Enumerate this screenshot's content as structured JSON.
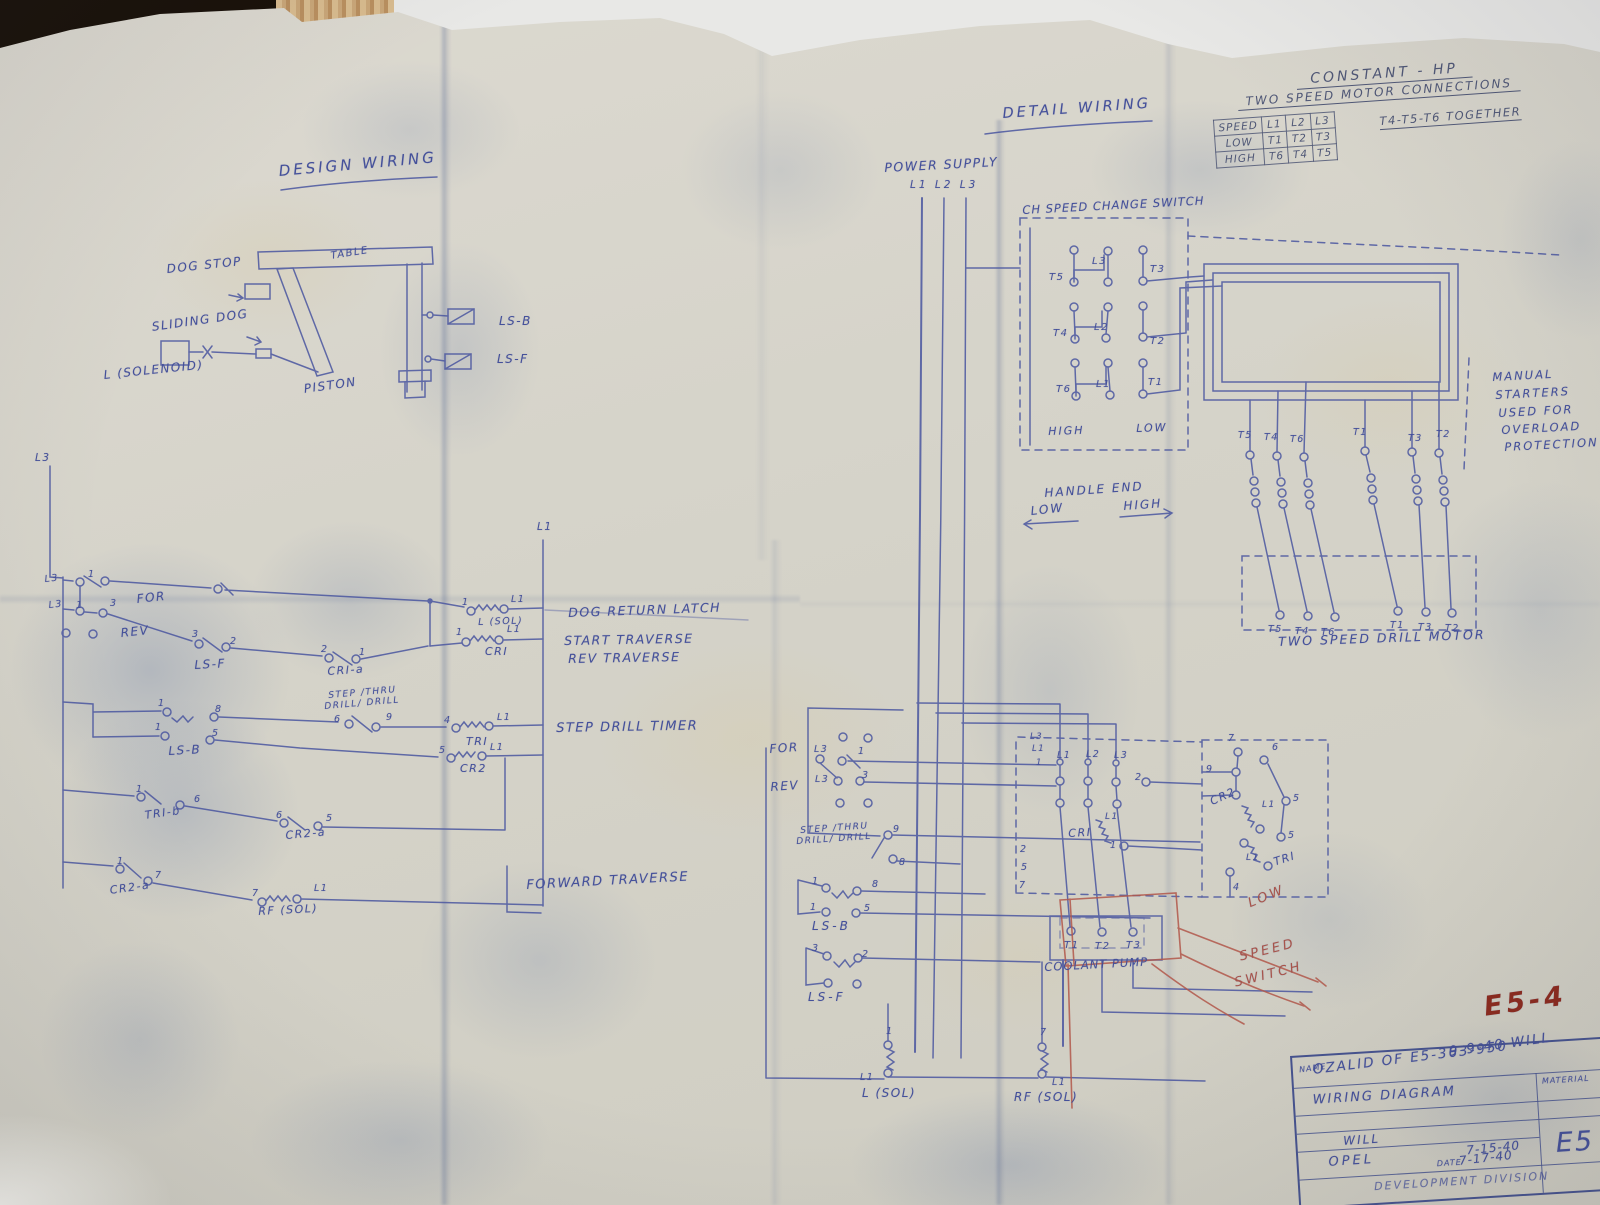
{
  "colors": {
    "ink": "#44509a",
    "table": "#4f5776",
    "red": "#a8544a",
    "marker": "#8c2a1e"
  },
  "titles": {
    "design_wiring": "DESIGN WIRING",
    "detail_wiring": "DETAIL WIRING"
  },
  "constant_hp_table": {
    "title_line1": "CONSTANT - HP",
    "title_line2": "TWO SPEED MOTOR CONNECTIONS",
    "header": [
      "SPEED",
      "L1",
      "L2",
      "L3"
    ],
    "rows": [
      {
        "speed": "LOW",
        "t": [
          "T1",
          "T2",
          "T3"
        ],
        "note": "T4-T5-T6 TOGETHER"
      },
      {
        "speed": "HIGH",
        "t": [
          "T6",
          "T4",
          "T5"
        ],
        "note": ""
      }
    ]
  },
  "title_block": {
    "name_label": "NAME",
    "drawing_name": "WIRING DIAGRAM",
    "material_label": "MATERIAL",
    "drawn_by": "WILL",
    "checked_by": "OPEL",
    "date_1": "7-15-40",
    "date_label": "DATE",
    "date_2": "7-17-40",
    "drawing_number": "E5",
    "division": "DEVELOPMENT DIVISION"
  },
  "annotations": [
    {
      "n": "label-dog-stop",
      "t": "DOG STOP",
      "x": 166,
      "y": 262,
      "fs": 12,
      "r": -6
    },
    {
      "n": "label-sliding-dog",
      "t": "SLIDING DOG",
      "x": 151,
      "y": 320,
      "fs": 12,
      "r": -8
    },
    {
      "n": "label-l-solenoid",
      "t": "L (SOLENOID)",
      "x": 103,
      "y": 368,
      "fs": 12,
      "r": -6
    },
    {
      "n": "label-piston",
      "t": "PISTON",
      "x": 303,
      "y": 382,
      "fs": 12,
      "r": -8
    },
    {
      "n": "label-table",
      "t": "TABLE",
      "x": 330,
      "y": 251,
      "fs": 10,
      "r": -9
    },
    {
      "n": "label-ls-b-mech",
      "t": "LS-B",
      "x": 499,
      "y": 314,
      "fs": 12
    },
    {
      "n": "label-ls-f-mech",
      "t": "LS-F",
      "x": 497,
      "y": 352,
      "fs": 12
    },
    {
      "n": "label-l3-feeder",
      "t": "L3",
      "x": 35,
      "y": 452,
      "fs": 10.5
    },
    {
      "n": "label-l1-bus",
      "t": "L1",
      "x": 537,
      "y": 521,
      "fs": 10.5
    },
    {
      "n": "label-l3-row1",
      "t": "L3",
      "x": 44,
      "y": 574,
      "fs": 9.5,
      "r": -6
    },
    {
      "n": "num-row1-1",
      "t": "1",
      "x": 88,
      "y": 569,
      "fs": 9.5
    },
    {
      "n": "label-for",
      "t": "FOR",
      "x": 136,
      "y": 592,
      "fs": 12,
      "r": -6
    },
    {
      "n": "label-l3-row2",
      "t": "L3",
      "x": 48,
      "y": 600,
      "fs": 9.5,
      "r": -6
    },
    {
      "n": "num-row2-1",
      "t": "1",
      "x": 76,
      "y": 600,
      "fs": 9.5
    },
    {
      "n": "num-row2-3",
      "t": "3",
      "x": 110,
      "y": 598,
      "fs": 9.5
    },
    {
      "n": "label-rev",
      "t": "REV",
      "x": 120,
      "y": 626,
      "fs": 12,
      "r": -6
    },
    {
      "n": "num-lsf-3",
      "t": "3",
      "x": 192,
      "y": 629,
      "fs": 9.5
    },
    {
      "n": "num-lsf-2",
      "t": "2",
      "x": 230,
      "y": 636,
      "fs": 9.5
    },
    {
      "n": "label-ladder-ls-f",
      "t": "LS-F",
      "x": 194,
      "y": 658,
      "fs": 12,
      "r": -3
    },
    {
      "n": "num-cria-2",
      "t": "2",
      "x": 321,
      "y": 644,
      "fs": 9.5
    },
    {
      "n": "num-cria-1",
      "t": "1",
      "x": 359,
      "y": 647,
      "fs": 9.5
    },
    {
      "n": "label-cri-a",
      "t": "CRI-a",
      "x": 327,
      "y": 665,
      "fs": 11,
      "r": -4
    },
    {
      "n": "num-rowa-1",
      "t": "1",
      "x": 462,
      "y": 597,
      "fs": 9.5
    },
    {
      "n": "label-rowa-l1",
      "t": "L1",
      "x": 511,
      "y": 594,
      "fs": 9.5
    },
    {
      "n": "label-l-sol-coil",
      "t": "L (SOL)",
      "x": 478,
      "y": 617,
      "fs": 9.5,
      "r": -2
    },
    {
      "n": "caption-dog-return-latch",
      "t": "DOG RETURN LATCH",
      "x": 568,
      "y": 605,
      "fs": 12.5,
      "r": -2
    },
    {
      "n": "num-rowb-1",
      "t": "1",
      "x": 456,
      "y": 627,
      "fs": 9.5
    },
    {
      "n": "label-rowb-l1",
      "t": "L1",
      "x": 507,
      "y": 624,
      "fs": 9.5
    },
    {
      "n": "label-cri-coil",
      "t": "CRI",
      "x": 485,
      "y": 645,
      "fs": 11
    },
    {
      "n": "caption-start-traverse",
      "t": "START TRAVERSE",
      "x": 564,
      "y": 633,
      "fs": 12.5,
      "r": -1
    },
    {
      "n": "caption-rev-traverse",
      "t": "REV TRAVERSE",
      "x": 568,
      "y": 651,
      "fs": 12.5,
      "r": -1
    },
    {
      "n": "num-lsb-1a",
      "t": "1",
      "x": 158,
      "y": 698,
      "fs": 9.5
    },
    {
      "n": "num-lsb-8",
      "t": "8",
      "x": 215,
      "y": 704,
      "fs": 9.5
    },
    {
      "n": "num-lsb-1b",
      "t": "1",
      "x": 155,
      "y": 722,
      "fs": 9.5
    },
    {
      "n": "num-lsb-5",
      "t": "5",
      "x": 212,
      "y": 728,
      "fs": 9.5
    },
    {
      "n": "label-ladder-ls-b",
      "t": "LS-B",
      "x": 168,
      "y": 744,
      "fs": 12,
      "r": -3
    },
    {
      "n": "label-ladder-sel-top",
      "t": "STEP /THRU",
      "x": 328,
      "y": 691,
      "fs": 9,
      "r": -5
    },
    {
      "n": "label-ladder-sel-bot",
      "t": "DRILL/ DRILL",
      "x": 324,
      "y": 702,
      "fs": 9,
      "r": -5
    },
    {
      "n": "num-sel-6",
      "t": "6",
      "x": 334,
      "y": 714,
      "fs": 9.5
    },
    {
      "n": "num-sel-9",
      "t": "9",
      "x": 386,
      "y": 712,
      "fs": 9.5
    },
    {
      "n": "num-rowc-4",
      "t": "4",
      "x": 444,
      "y": 715,
      "fs": 9.5
    },
    {
      "n": "label-rowc-l1",
      "t": "L1",
      "x": 497,
      "y": 712,
      "fs": 9.5
    },
    {
      "n": "label-tri-coil",
      "t": "TRI",
      "x": 466,
      "y": 735,
      "fs": 11
    },
    {
      "n": "caption-step-drill-timer",
      "t": "STEP DRILL TIMER",
      "x": 556,
      "y": 721,
      "fs": 13,
      "r": -1
    },
    {
      "n": "num-rowd-5",
      "t": "5",
      "x": 439,
      "y": 745,
      "fs": 9.5
    },
    {
      "n": "label-rowd-l1",
      "t": "L1",
      "x": 490,
      "y": 742,
      "fs": 9.5
    },
    {
      "n": "label-cr2-coil",
      "t": "CR2",
      "x": 460,
      "y": 762,
      "fs": 11
    },
    {
      "n": "num-trib-1",
      "t": "1",
      "x": 136,
      "y": 784,
      "fs": 9.5
    },
    {
      "n": "num-trib-6",
      "t": "6",
      "x": 194,
      "y": 794,
      "fs": 9.5
    },
    {
      "n": "label-tri-b",
      "t": "TRI-b",
      "x": 144,
      "y": 809,
      "fs": 11,
      "r": -8
    },
    {
      "n": "num-cr2a1-6",
      "t": "6",
      "x": 276,
      "y": 810,
      "fs": 9.5
    },
    {
      "n": "num-cr2a1-5",
      "t": "5",
      "x": 326,
      "y": 813,
      "fs": 9.5
    },
    {
      "n": "label-cr2-a-1",
      "t": "CR2-a",
      "x": 285,
      "y": 829,
      "fs": 11,
      "r": -5
    },
    {
      "n": "num-cr2a2-1",
      "t": "1",
      "x": 117,
      "y": 856,
      "fs": 9.5
    },
    {
      "n": "num-cr2a2-7",
      "t": "7",
      "x": 155,
      "y": 870,
      "fs": 9.5
    },
    {
      "n": "label-cr2-a-2",
      "t": "CR2-a",
      "x": 109,
      "y": 884,
      "fs": 11,
      "r": -8
    },
    {
      "n": "num-rowe-7",
      "t": "7",
      "x": 252,
      "y": 888,
      "fs": 9.5
    },
    {
      "n": "label-rowe-l1",
      "t": "L1",
      "x": 314,
      "y": 883,
      "fs": 9.5
    },
    {
      "n": "label-rf-sol-coil",
      "t": "RF (SOL)",
      "x": 258,
      "y": 905,
      "fs": 11,
      "r": -3
    },
    {
      "n": "caption-forward-traverse",
      "t": "FORWARD TRAVERSE",
      "x": 526,
      "y": 878,
      "fs": 13,
      "r": -3
    },
    {
      "n": "label-power-supply",
      "t": "POWER SUPPLY",
      "x": 884,
      "y": 160,
      "fs": 12.5,
      "r": -3
    },
    {
      "n": "label-power-lines",
      "t": "L1 L2 L3",
      "x": 910,
      "y": 179,
      "fs": 10.5,
      "ls": 3
    },
    {
      "n": "label-speed-change-switch",
      "t": "CH SPEED CHANGE SWITCH",
      "x": 1022,
      "y": 203,
      "fs": 11.5,
      "r": -3,
      "ls": 1
    },
    {
      "n": "label-sw-l3",
      "t": "L3",
      "x": 1092,
      "y": 256,
      "fs": 10
    },
    {
      "n": "label-sw-t5",
      "t": "T5",
      "x": 1049,
      "y": 272,
      "fs": 10
    },
    {
      "n": "label-sw-t3",
      "t": "T3",
      "x": 1150,
      "y": 264,
      "fs": 10
    },
    {
      "n": "label-sw-t4",
      "t": "T4",
      "x": 1053,
      "y": 328,
      "fs": 10
    },
    {
      "n": "label-sw-l2",
      "t": "L2",
      "x": 1094,
      "y": 322,
      "fs": 10
    },
    {
      "n": "label-sw-t2",
      "t": "T2",
      "x": 1150,
      "y": 336,
      "fs": 10
    },
    {
      "n": "label-sw-t6",
      "t": "T6",
      "x": 1056,
      "y": 384,
      "fs": 10
    },
    {
      "n": "label-sw-l1",
      "t": "L1",
      "x": 1096,
      "y": 379,
      "fs": 10
    },
    {
      "n": "label-sw-t1",
      "t": "T1",
      "x": 1148,
      "y": 377,
      "fs": 10
    },
    {
      "n": "label-sw-high",
      "t": "HIGH",
      "x": 1048,
      "y": 425,
      "fs": 11,
      "r": -2,
      "ls": 2
    },
    {
      "n": "label-sw-low",
      "t": "LOW",
      "x": 1136,
      "y": 422,
      "fs": 11,
      "r": -2,
      "ls": 2
    },
    {
      "n": "label-handle-end",
      "t": "HANDLE END",
      "x": 1044,
      "y": 486,
      "fs": 12,
      "r": -4,
      "ls": 2
    },
    {
      "n": "label-handle-low",
      "t": "LOW",
      "x": 1030,
      "y": 504,
      "fs": 12,
      "r": -6,
      "ls": 2
    },
    {
      "n": "label-handle-high",
      "t": "HIGH",
      "x": 1123,
      "y": 499,
      "fs": 12,
      "r": -4,
      "ls": 2
    },
    {
      "n": "note-manual-1",
      "t": "MANUAL",
      "x": 1492,
      "y": 370,
      "fs": 11.5,
      "r": -3,
      "ls": 2
    },
    {
      "n": "note-manual-2",
      "t": "STARTERS",
      "x": 1495,
      "y": 388,
      "fs": 11.5,
      "r": -3,
      "ls": 2
    },
    {
      "n": "note-manual-3",
      "t": "USED FOR",
      "x": 1498,
      "y": 406,
      "fs": 11.5,
      "r": -3,
      "ls": 2
    },
    {
      "n": "note-manual-4",
      "t": "OVERLOAD",
      "x": 1501,
      "y": 423,
      "fs": 11.5,
      "r": -3,
      "ls": 2
    },
    {
      "n": "note-manual-5",
      "t": "PROTECTION",
      "x": 1504,
      "y": 440,
      "fs": 11.5,
      "r": -3,
      "ls": 2
    },
    {
      "n": "label-st1-top-t5",
      "t": "T5",
      "x": 1238,
      "y": 430,
      "fs": 9.5
    },
    {
      "n": "label-st1-top-t4",
      "t": "T4",
      "x": 1264,
      "y": 432,
      "fs": 9.5
    },
    {
      "n": "label-st1-top-t6",
      "t": "T6",
      "x": 1290,
      "y": 434,
      "fs": 9.5
    },
    {
      "n": "label-st2-top-t1",
      "t": "T1",
      "x": 1353,
      "y": 427,
      "fs": 9.5
    },
    {
      "n": "label-st2-top-t3",
      "t": "T3",
      "x": 1408,
      "y": 433,
      "fs": 9.5
    },
    {
      "n": "label-st2-top-t2",
      "t": "T2",
      "x": 1436,
      "y": 429,
      "fs": 9.5
    },
    {
      "n": "label-st1-bot-t5",
      "t": "T5",
      "x": 1268,
      "y": 624,
      "fs": 9.5
    },
    {
      "n": "label-st1-bot-t4",
      "t": "T4",
      "x": 1295,
      "y": 626,
      "fs": 9.5
    },
    {
      "n": "label-st1-bot-t6",
      "t": "T6",
      "x": 1321,
      "y": 627,
      "fs": 9.5
    },
    {
      "n": "label-st2-bot-t1",
      "t": "T1",
      "x": 1390,
      "y": 620,
      "fs": 9.5
    },
    {
      "n": "label-st2-bot-t3",
      "t": "T3",
      "x": 1418,
      "y": 622,
      "fs": 9.5
    },
    {
      "n": "label-st2-bot-t2",
      "t": "T2",
      "x": 1445,
      "y": 623,
      "fs": 9.5
    },
    {
      "n": "label-two-speed-drill-motor",
      "t": "TWO SPEED DRILL MOTOR",
      "x": 1278,
      "y": 634,
      "fs": 12.5,
      "r": -2,
      "ls": 2
    },
    {
      "n": "label-det-for",
      "t": "FOR",
      "x": 769,
      "y": 742,
      "fs": 12,
      "r": -4
    },
    {
      "n": "label-det-l3-for",
      "t": "L3",
      "x": 814,
      "y": 744,
      "fs": 9.5
    },
    {
      "n": "num-det-for-1",
      "t": "1",
      "x": 858,
      "y": 746,
      "fs": 9.5
    },
    {
      "n": "label-det-rev",
      "t": "REV",
      "x": 770,
      "y": 780,
      "fs": 12,
      "r": -4
    },
    {
      "n": "label-det-l3-rev",
      "t": "L3",
      "x": 815,
      "y": 774,
      "fs": 9.5
    },
    {
      "n": "num-det-rev-3",
      "t": "3",
      "x": 862,
      "y": 770,
      "fs": 9.5
    },
    {
      "n": "label-det-sel-top",
      "t": "STEP /THRU",
      "x": 800,
      "y": 826,
      "fs": 9,
      "r": -4
    },
    {
      "n": "label-det-sel-bot",
      "t": "DRILL/ DRILL",
      "x": 796,
      "y": 837,
      "fs": 9,
      "r": -4
    },
    {
      "n": "num-det-sel-9",
      "t": "9",
      "x": 893,
      "y": 824,
      "fs": 9.5
    },
    {
      "n": "num-det-sel-8",
      "t": "8",
      "x": 899,
      "y": 857,
      "fs": 9.5
    },
    {
      "n": "num-det-lsb-1a",
      "t": "1",
      "x": 812,
      "y": 876,
      "fs": 9.5
    },
    {
      "n": "num-det-lsb-8",
      "t": "8",
      "x": 872,
      "y": 879,
      "fs": 9.5
    },
    {
      "n": "num-det-lsb-1b",
      "t": "1",
      "x": 810,
      "y": 902,
      "fs": 9.5
    },
    {
      "n": "num-det-lsb-5",
      "t": "5",
      "x": 864,
      "y": 903,
      "fs": 9.5
    },
    {
      "n": "label-det-ls-b",
      "t": "LS-B",
      "x": 812,
      "y": 919,
      "fs": 12,
      "ls": 3
    },
    {
      "n": "num-det-lsf-3",
      "t": "3",
      "x": 812,
      "y": 943,
      "fs": 9.5
    },
    {
      "n": "num-det-lsf-2",
      "t": "2",
      "x": 862,
      "y": 949,
      "fs": 9.5
    },
    {
      "n": "label-det-ls-f",
      "t": "LS-F",
      "x": 808,
      "y": 990,
      "fs": 12,
      "ls": 3
    },
    {
      "n": "num-det-lsol-1",
      "t": "1",
      "x": 886,
      "y": 1026,
      "fs": 9.5
    },
    {
      "n": "label-det-lsol-l1",
      "t": "L1",
      "x": 860,
      "y": 1072,
      "fs": 9.5
    },
    {
      "n": "label-det-l-sol",
      "t": "L (SOL)",
      "x": 862,
      "y": 1086,
      "fs": 12
    },
    {
      "n": "num-det-rfsol-7",
      "t": "7",
      "x": 1040,
      "y": 1027,
      "fs": 9.5
    },
    {
      "n": "label-det-rfsol-l1",
      "t": "L1",
      "x": 1052,
      "y": 1077,
      "fs": 9.5
    },
    {
      "n": "label-det-rf-sol",
      "t": "RF (SOL)",
      "x": 1014,
      "y": 1090,
      "fs": 12
    },
    {
      "n": "label-det-ctr-l1",
      "t": "L1",
      "x": 1057,
      "y": 750,
      "fs": 9.5
    },
    {
      "n": "label-det-ctr-l2",
      "t": "L2",
      "x": 1086,
      "y": 749,
      "fs": 9.5
    },
    {
      "n": "label-det-ctr-l3",
      "t": "L3",
      "x": 1114,
      "y": 750,
      "fs": 9.5
    },
    {
      "n": "num-det-ctr-2",
      "t": "2",
      "x": 1135,
      "y": 772,
      "fs": 9.5
    },
    {
      "n": "label-det-cri",
      "t": "CRI",
      "x": 1068,
      "y": 827,
      "fs": 11,
      "r": -3
    },
    {
      "n": "label-det-cri-l1",
      "t": "L1",
      "x": 1105,
      "y": 812,
      "fs": 9
    },
    {
      "n": "num-det-cri-1",
      "t": "1",
      "x": 1110,
      "y": 840,
      "fs": 9.5
    },
    {
      "n": "num-wire-2",
      "t": "2",
      "x": 1020,
      "y": 844,
      "fs": 9.5
    },
    {
      "n": "num-wire-5",
      "t": "5",
      "x": 1021,
      "y": 862,
      "fs": 9.5
    },
    {
      "n": "num-wire-7",
      "t": "7",
      "x": 1019,
      "y": 880,
      "fs": 9.5
    },
    {
      "n": "label-wire-l3",
      "t": "L3",
      "x": 1030,
      "y": 732,
      "fs": 8.5
    },
    {
      "n": "label-wire-l1",
      "t": "L1",
      "x": 1032,
      "y": 744,
      "fs": 8.5
    },
    {
      "n": "num-wire-1",
      "t": "1",
      "x": 1036,
      "y": 758,
      "fs": 8.5
    },
    {
      "n": "num-dr-7a",
      "t": "7",
      "x": 1228,
      "y": 733,
      "fs": 9.5
    },
    {
      "n": "num-dr-6",
      "t": "6",
      "x": 1272,
      "y": 742,
      "fs": 9.5
    },
    {
      "n": "num-dr-9",
      "t": "9",
      "x": 1206,
      "y": 764,
      "fs": 9.5
    },
    {
      "n": "label-det-cr2",
      "t": "CR2",
      "x": 1208,
      "y": 796,
      "fs": 11,
      "r": -24
    },
    {
      "n": "label-det-cr2-l1",
      "t": "L1",
      "x": 1262,
      "y": 800,
      "fs": 9
    },
    {
      "n": "num-dr-5a",
      "t": "5",
      "x": 1293,
      "y": 793,
      "fs": 9.5
    },
    {
      "n": "num-dr-5b",
      "t": "5",
      "x": 1288,
      "y": 830,
      "fs": 9.5
    },
    {
      "n": "label-det-tri",
      "t": "TRI",
      "x": 1272,
      "y": 856,
      "fs": 11,
      "r": -18
    },
    {
      "n": "label-det-tri-l1",
      "t": "L1",
      "x": 1246,
      "y": 853,
      "fs": 9
    },
    {
      "n": "num-dr-4",
      "t": "4",
      "x": 1233,
      "y": 882,
      "fs": 9.5
    },
    {
      "n": "label-cp-t1",
      "t": "T1",
      "x": 1064,
      "y": 940,
      "fs": 10
    },
    {
      "n": "label-cp-t2",
      "t": "T2",
      "x": 1095,
      "y": 941,
      "fs": 10
    },
    {
      "n": "label-cp-t3",
      "t": "T3",
      "x": 1126,
      "y": 940,
      "fs": 10
    },
    {
      "n": "label-coolant-pump",
      "t": "COOLANT PUMP",
      "x": 1044,
      "y": 960,
      "fs": 11.5,
      "r": -3,
      "ls": 1
    },
    {
      "n": "label-red-low",
      "t": "LOW",
      "x": 1246,
      "y": 897,
      "fs": 13,
      "r": -22,
      "c": "red",
      "ls": 3
    },
    {
      "n": "label-red-speed",
      "t": "SPEED",
      "x": 1238,
      "y": 950,
      "fs": 13,
      "r": -14,
      "c": "red",
      "ls": 3
    },
    {
      "n": "label-red-switch",
      "t": "SWITCH",
      "x": 1233,
      "y": 976,
      "fs": 13,
      "r": -14,
      "c": "red",
      "ls": 3
    },
    {
      "n": "marker-e5-4",
      "t": "E5-4",
      "x": 1482,
      "y": 992,
      "fs": 27,
      "r": -8,
      "c": "marker",
      "w": 700,
      "ls": 4
    },
    {
      "n": "note-date-will",
      "t": "9-9-40 WILL",
      "x": 1448,
      "y": 1044,
      "fs": 13.5,
      "r": -8,
      "ls": 2
    },
    {
      "n": "note-ozalid",
      "t": "OZALID OF E5-363-950",
      "x": 1312,
      "y": 1062,
      "fs": 13.5,
      "r": -7,
      "ls": 2
    }
  ]
}
